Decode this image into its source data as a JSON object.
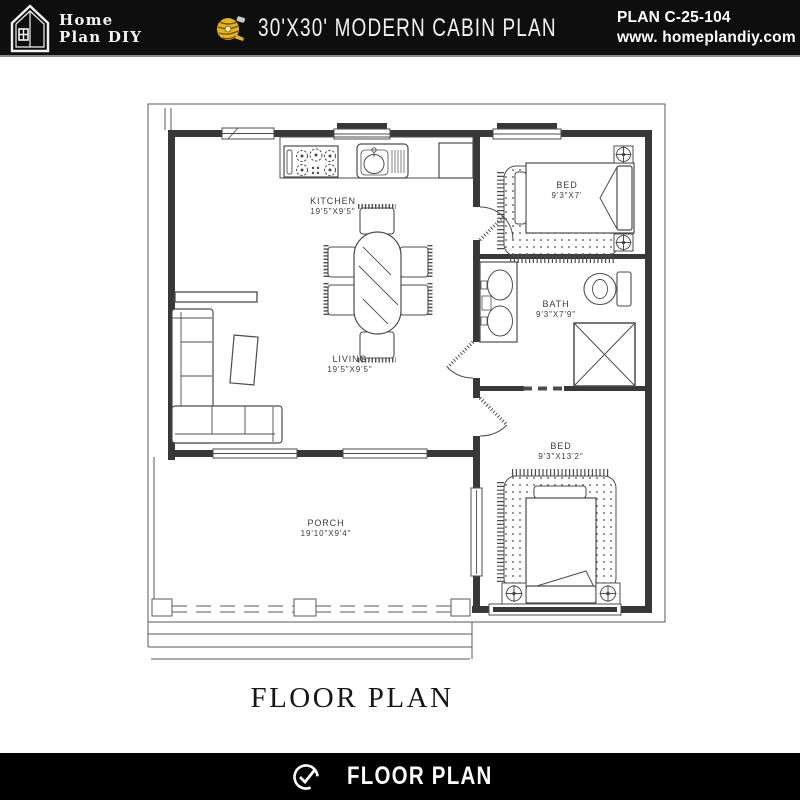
{
  "header": {
    "logo": {
      "line1": "Home",
      "line2": "Plan DIY"
    },
    "title": "30'X30' MODERN CABIN PLAN",
    "plan_code": "PLAN C-25-104",
    "website": "www. homeplandiy.com"
  },
  "plan": {
    "rooms": [
      {
        "name": "KITCHEN",
        "size": "19'5\"X9'5\""
      },
      {
        "name": "LIVING",
        "size": "19'5\"X9'5\""
      },
      {
        "name": "BED",
        "size": "9'3\"X7'"
      },
      {
        "name": "BATH",
        "size": "9'3\"X7'9\""
      },
      {
        "name": "BED",
        "size": "9'3\"X13'2\""
      },
      {
        "name": "PORCH",
        "size": "19'10\"X9'4\""
      }
    ]
  },
  "caption": "FLOOR PLAN",
  "footer": {
    "label": "FLOOR PLAN"
  },
  "icons": {
    "logo": "house-icon",
    "title": "tape-measure-icon",
    "footer": "check-circle-icon"
  },
  "colors": {
    "header_bg": "#0e0e0e",
    "footer_bg": "#000000",
    "tape_yellow": "#e6b327",
    "wall": "#383838",
    "line": "#4c4c4c"
  }
}
